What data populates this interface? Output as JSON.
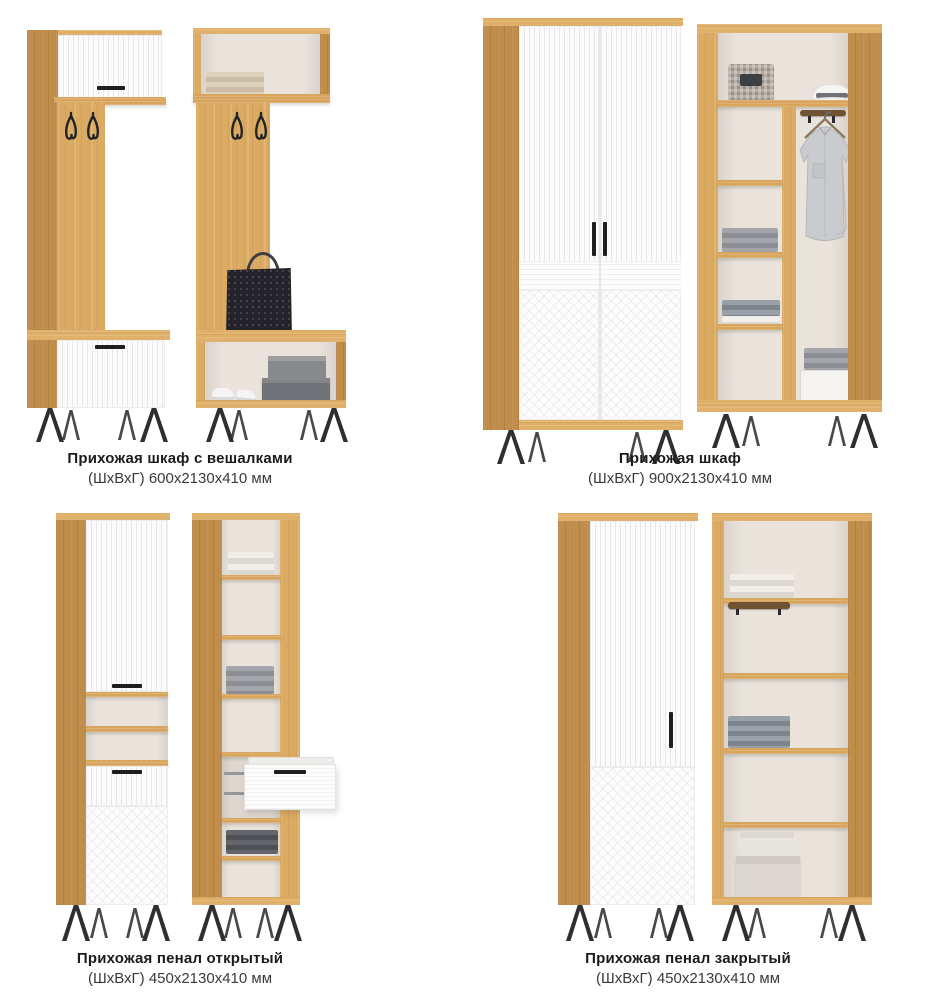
{
  "page": {
    "background": "#ffffff"
  },
  "palette": {
    "wood": "#dcab63",
    "wood_side": "#c08d4b",
    "wood_light": "#e0b069",
    "white_front": "#fbfbfb",
    "interior_back": "#eae3dc",
    "metal_black": "#2f2f33",
    "text_primary": "#1b1b1d",
    "text_secondary": "#3a3a3c"
  },
  "products": [
    {
      "id": "hallway-wardrobe-with-hooks",
      "title": "Прихожая шкаф с вешалками",
      "dimensions": "(ШхВхГ) 600х2130х410 мм"
    },
    {
      "id": "hallway-wardrobe",
      "title": "Прихожая шкаф",
      "dimensions": "(ШхВхГ) 900х2130х410 мм"
    },
    {
      "id": "hallway-cabinet-open",
      "title": "Прихожая пенал открытый",
      "dimensions": "(ШхВхГ) 450х2130х410 мм"
    },
    {
      "id": "hallway-cabinet-closed",
      "title": "Прихожая пенал закрытый",
      "dimensions": "(ШхВхГ) 450х2130х410 мм"
    }
  ]
}
